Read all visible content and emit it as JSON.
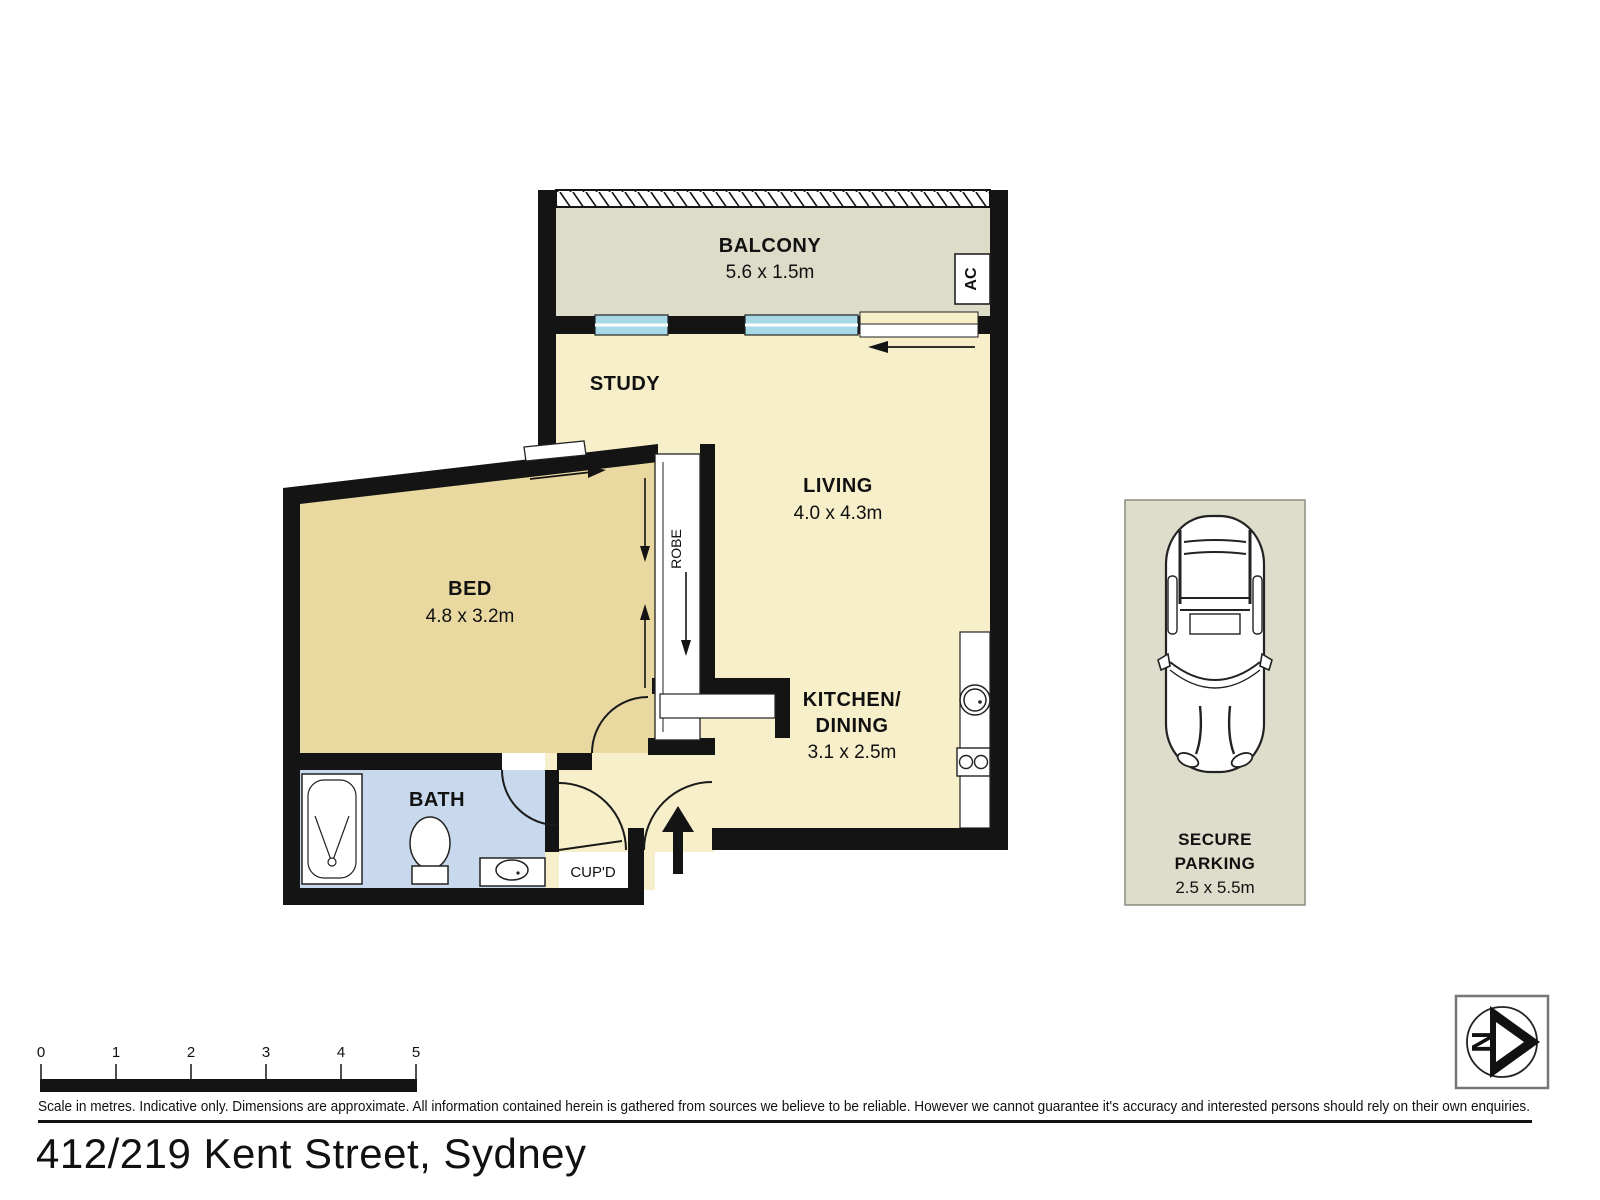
{
  "labels": {
    "balcony": "BALCONY",
    "balcony_dims": "5.6 x 1.5m",
    "study": "STUDY",
    "living": "LIVING",
    "living_dims": "4.0 x 4.3m",
    "bed": "BED",
    "bed_dims": "4.8 x 3.2m",
    "bath": "BATH",
    "kitchen_line1": "KITCHEN/",
    "kitchen_line2": "DINING",
    "kitchen_dims": "3.1 x 2.5m",
    "cupd": "CUP'D",
    "robe": "ROBE",
    "ac": "AC",
    "parking_line1": "SECURE",
    "parking_line2": "PARKING",
    "parking_dims": "2.5 x 5.5m"
  },
  "scale_bar": {
    "ticks": [
      "0",
      "1",
      "2",
      "3",
      "4",
      "5"
    ]
  },
  "compass": {
    "north": "N"
  },
  "footer": {
    "disclaimer": "Scale in metres. Indicative only. Dimensions are approximate. All information contained herein is gathered from sources we believe to be reliable. However we cannot guarantee it's accuracy and interested persons should rely on their own enquiries.",
    "address": "412/219 Kent Street, Sydney"
  },
  "colors": {
    "wall": "#141414",
    "living_fill": "#f6efca",
    "bed_fill": "#e9d9a1",
    "bath_fill": "#c8d9ed",
    "balcony_fill": "#dcdcc9",
    "parking_fill": "#dedcca",
    "window_glass": "#a7d9e7"
  }
}
